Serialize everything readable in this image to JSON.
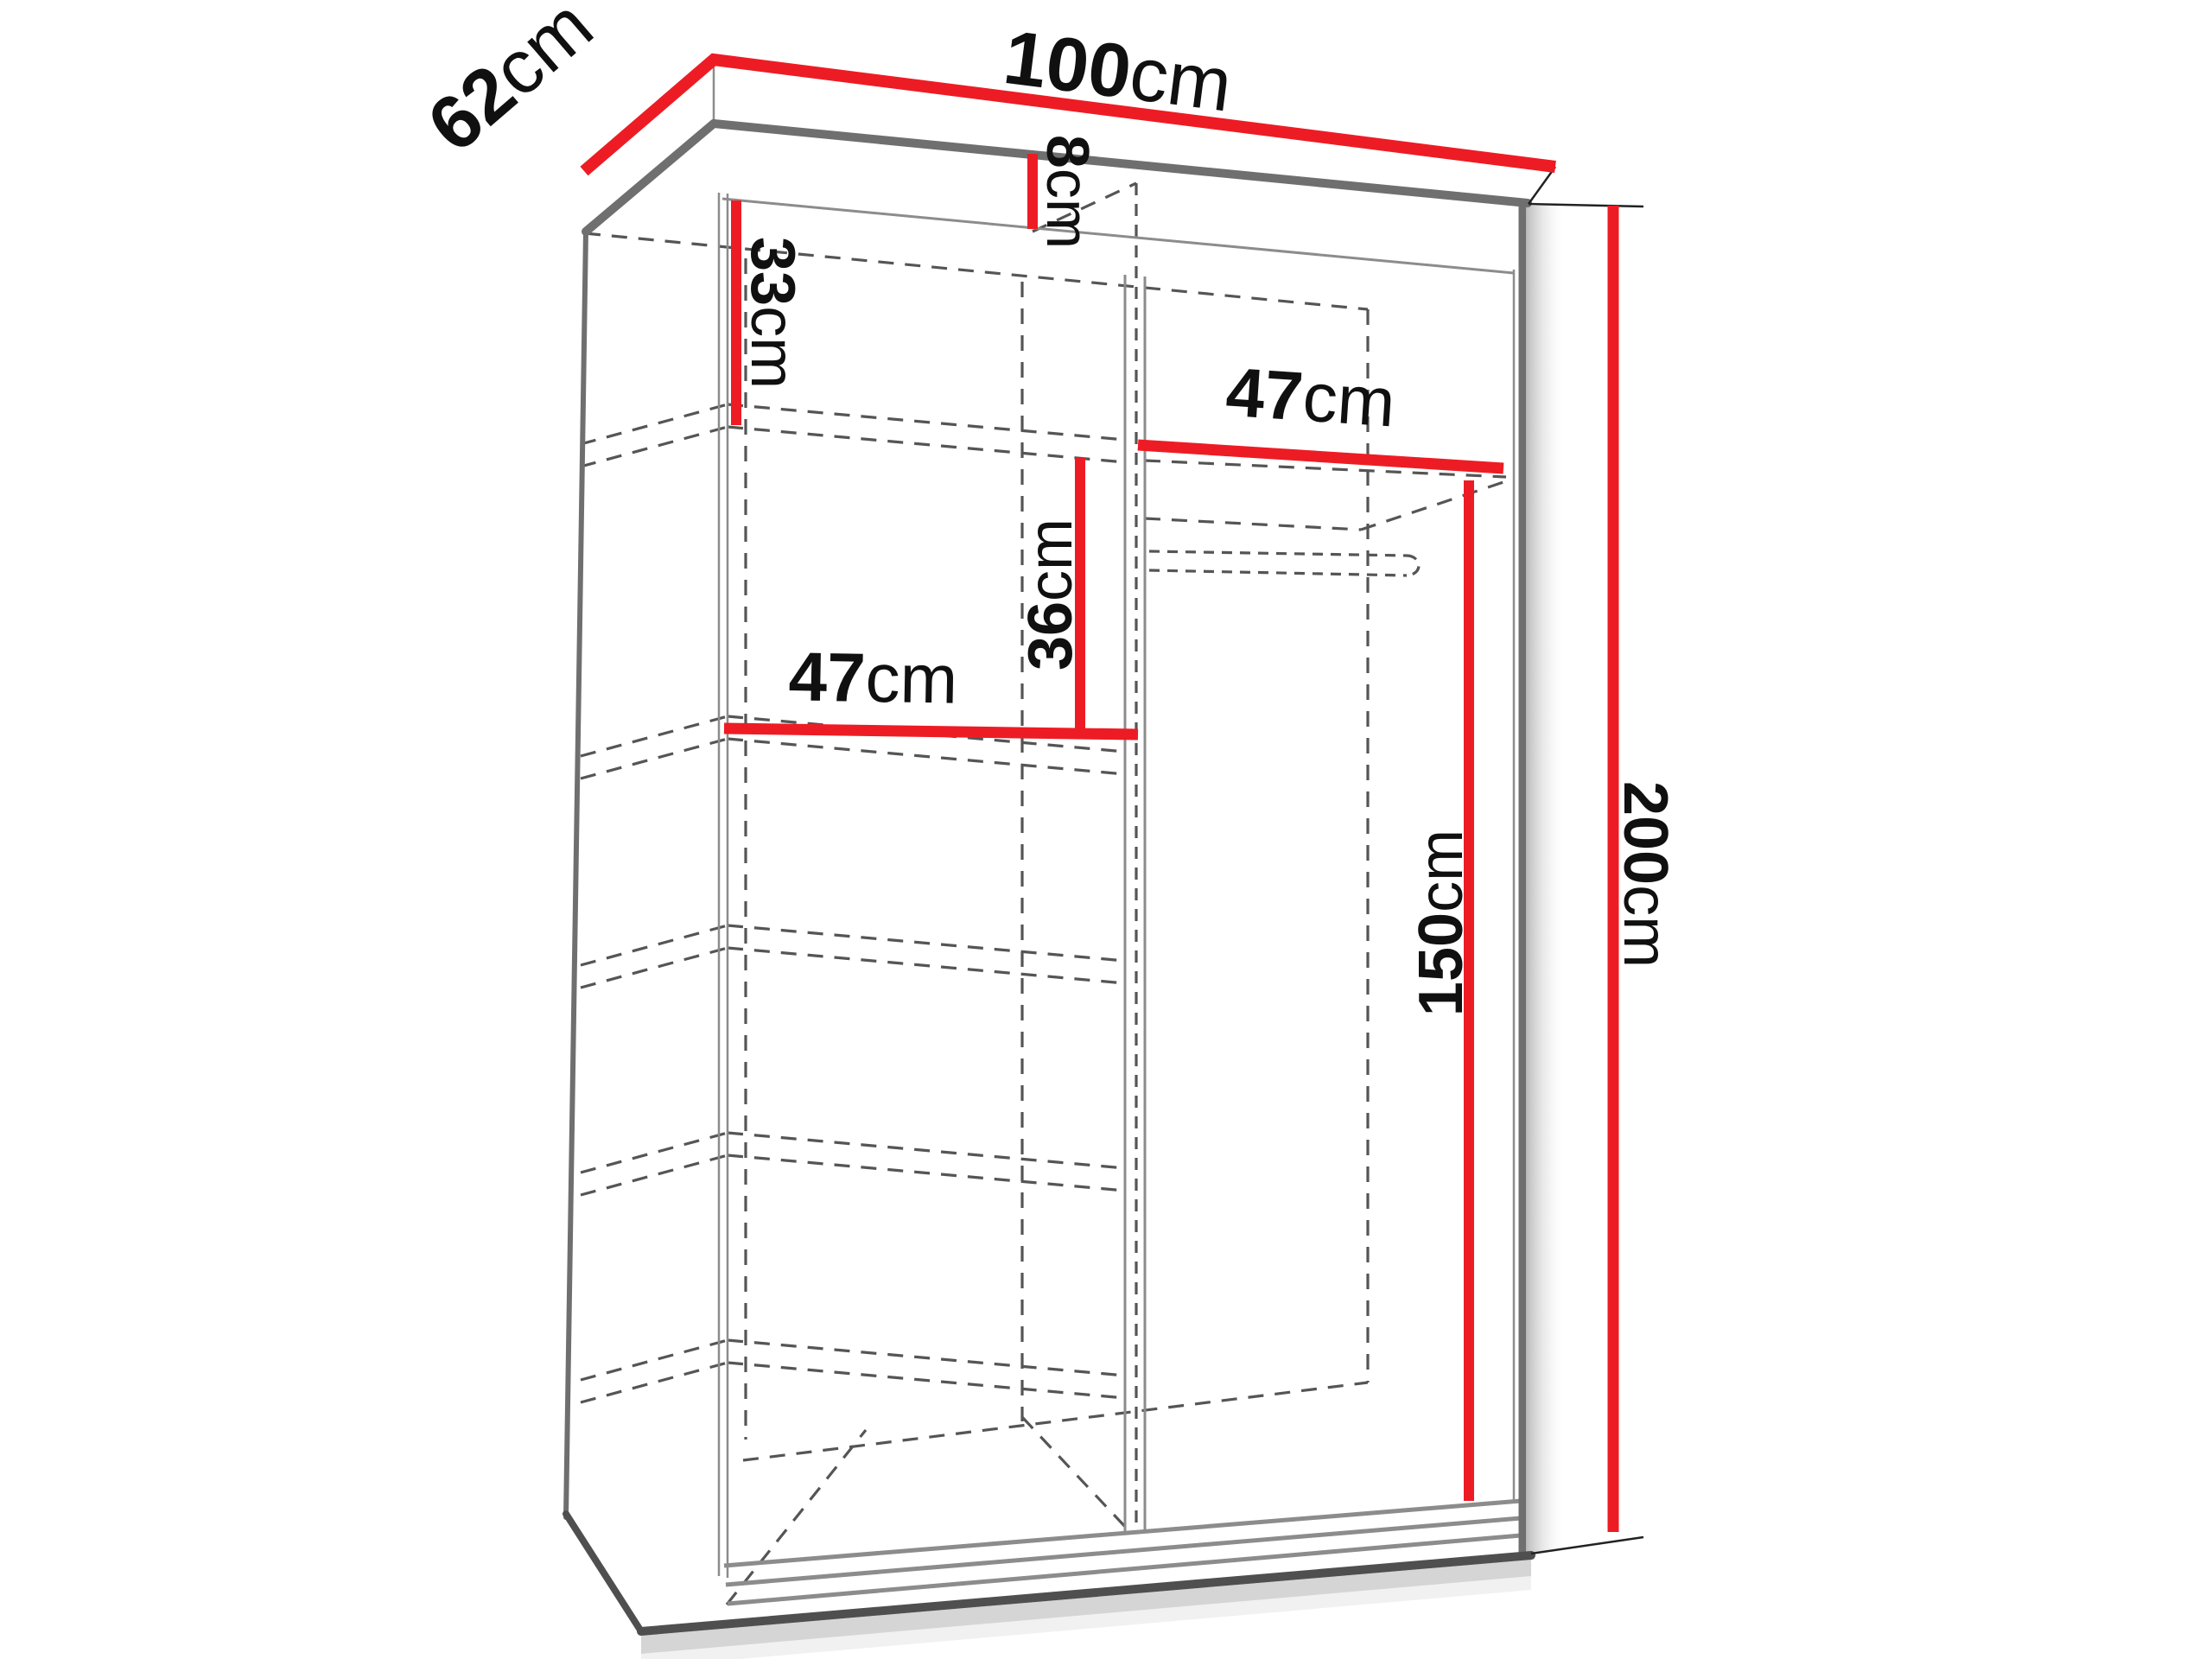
{
  "page": {
    "background": "#ffffff"
  },
  "colors": {
    "dimension": "#ED1C24",
    "outline": "#6f6f6f",
    "outline_thin": "#8c8c8c",
    "edge_dark": "#4f4f4f",
    "dashed": "#555555",
    "label": "#101010"
  },
  "dimensions": {
    "width_top": {
      "value": "100",
      "unit": "cm"
    },
    "depth_top": {
      "value": "62",
      "unit": "cm"
    },
    "top_rail": {
      "value": "8",
      "unit": "cm"
    },
    "top_section": {
      "value": "33",
      "unit": "cm"
    },
    "shelf_right": {
      "value": "47",
      "unit": "cm"
    },
    "shelf_gap": {
      "value": "36",
      "unit": "cm"
    },
    "shelf_left": {
      "value": "47",
      "unit": "cm"
    },
    "hanging_space": {
      "value": "150",
      "unit": "cm"
    },
    "total_height": {
      "value": "200",
      "unit": "cm"
    }
  }
}
